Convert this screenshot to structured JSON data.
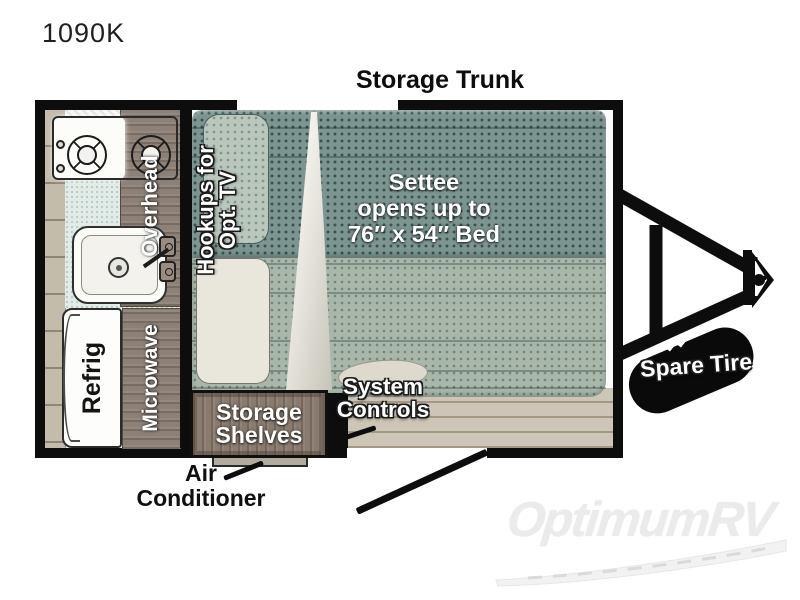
{
  "model": "1090K",
  "floorplan": {
    "storage_trunk": "Storage Trunk",
    "overhead": "Overhead",
    "hookups": {
      "line1": "Hookups for",
      "line2": "Opt. TV"
    },
    "settee": {
      "line1": "Settee",
      "line2": "opens up to",
      "line3": "76″ x 54″ Bed"
    },
    "refrig": "Refrig",
    "microwave": "Microwave",
    "storage_shelves": {
      "line1": "Storage",
      "line2": "Shelves"
    },
    "system_controls": {
      "line1": "System",
      "line2": "Controls"
    },
    "air_conditioner": {
      "line1": "Air",
      "line2": "Conditioner"
    },
    "spare_tire": "Spare Tire"
  },
  "watermark": "OptimumRV",
  "colors": {
    "wall": "#0d0d0d",
    "settee_dark": "#7d9591",
    "settee_light": "#a9b7ab",
    "floor": "#cdc6b6",
    "counter": "#e2ebe6",
    "wood": "#8d8177",
    "trim_strip": "#c4bcab",
    "watermark_gray": "#ebebeb"
  }
}
